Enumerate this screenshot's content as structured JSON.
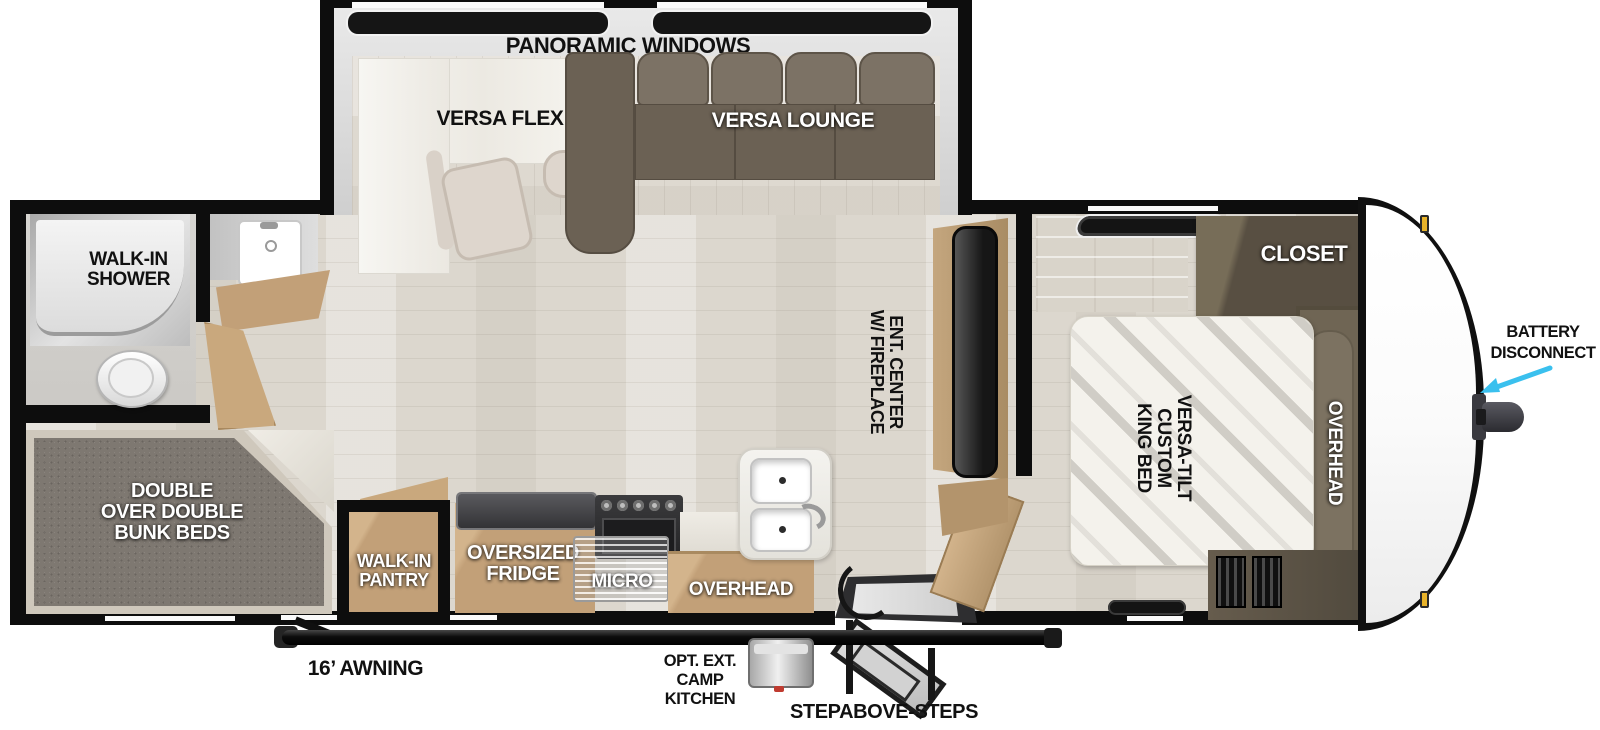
{
  "title": "Travel trailer floorplan",
  "colors": {
    "wall": "#0d0d0d",
    "floor_wood": "#dcd7ce",
    "cabinet_tan": "#c2a078",
    "dark_wood": "#5a5145",
    "sofa": "#6b6154",
    "bunk_carpet": "#7e7871",
    "arrow_cyan": "#3ac0ee",
    "clearance_amber": "#e8b32a"
  },
  "slide_out": {
    "panoramic_windows": "PANORAMIC WINDOWS",
    "versa_flex": "VERSA FLEX",
    "versa_lounge": "VERSA LOUNGE"
  },
  "bathroom": {
    "shower": [
      "WALK-IN",
      "SHOWER"
    ]
  },
  "bunk_room": {
    "label": [
      "DOUBLE",
      "OVER DOUBLE",
      "BUNK BEDS"
    ]
  },
  "kitchen": {
    "pantry": [
      "WALK-IN",
      "PANTRY"
    ],
    "fridge": [
      "OVERSIZED",
      "FRIDGE"
    ],
    "micro": "MICRO",
    "overhead": "OVERHEAD"
  },
  "living": {
    "ent_center": [
      "ENT. CENTER",
      "W/ FIREPLACE"
    ]
  },
  "bedroom": {
    "closet": "CLOSET",
    "bed": [
      "VERSA-TILT",
      "CUSTOM",
      "KING BED"
    ],
    "overhead": "OVERHEAD"
  },
  "exterior": {
    "battery": [
      "BATTERY",
      "DISCONNECT"
    ],
    "awning": "16’ AWNING",
    "camp_kitchen": [
      "OPT. EXT.",
      "CAMP",
      "KITCHEN"
    ],
    "steps": "STEPABOVE-STEPS"
  }
}
